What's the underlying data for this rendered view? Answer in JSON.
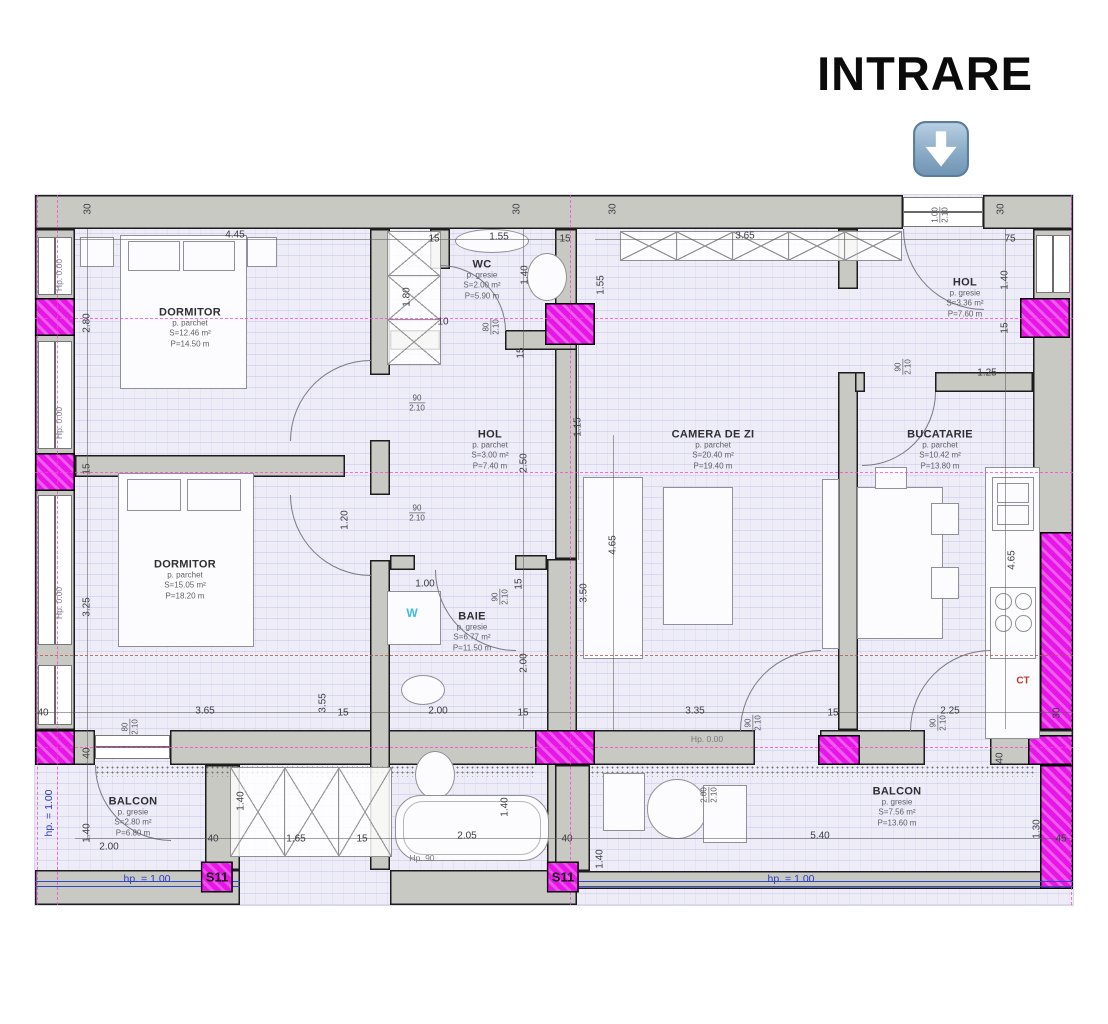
{
  "entrance": {
    "heading": "INTRARE",
    "icon": "down-arrow-icon"
  },
  "rooms": [
    {
      "id": "dormitor-1",
      "name": "DORMITOR",
      "floor": "p. parchet",
      "area": "S=12.46 m²",
      "perimeter": "P=14.50 m",
      "x": 155,
      "y": 133
    },
    {
      "id": "wc",
      "name": "WC",
      "floor": "p. gresie",
      "area": "S=2.00 m²",
      "perimeter": "P=5.90 m",
      "x": 447,
      "y": 85
    },
    {
      "id": "hol-entry",
      "name": "HOL",
      "floor": "p. gresie",
      "area": "S=3.36 m²",
      "perimeter": "P=7.60 m",
      "x": 930,
      "y": 103
    },
    {
      "id": "hol",
      "name": "HOL",
      "floor": "p. parchet",
      "area": "S=3.00 m²",
      "perimeter": "P=7.40 m",
      "x": 455,
      "y": 255
    },
    {
      "id": "camera-de-zi",
      "name": "CAMERA DE ZI",
      "floor": "p. parchet",
      "area": "S=20.40 m²",
      "perimeter": "P=19.40 m",
      "x": 678,
      "y": 255
    },
    {
      "id": "bucatarie",
      "name": "BUCATARIE",
      "floor": "p. parchet",
      "area": "S=10.42 m²",
      "perimeter": "P=13.80 m",
      "x": 905,
      "y": 255
    },
    {
      "id": "dormitor-2",
      "name": "DORMITOR",
      "floor": "p. parchet",
      "area": "S=15.05 m²",
      "perimeter": "P=18.20 m",
      "x": 150,
      "y": 385
    },
    {
      "id": "baie",
      "name": "BAIE",
      "floor": "p. gresie",
      "area": "S=6.77 m²",
      "perimeter": "P=11.50 m",
      "x": 437,
      "y": 437
    },
    {
      "id": "balcon-1",
      "name": "BALCON",
      "floor": "p. gresie",
      "area": "S=2.80 m²",
      "perimeter": "P=6.80 m",
      "x": 98,
      "y": 622
    },
    {
      "id": "balcon-2",
      "name": "BALCON",
      "floor": "p. gresie",
      "area": "S=7.56 m²",
      "perimeter": "P=13.60 m",
      "x": 862,
      "y": 612
    }
  ],
  "dims": [
    {
      "t": "30",
      "x": 53,
      "y": 14,
      "r": 1
    },
    {
      "t": "4.45",
      "x": 200,
      "y": 40
    },
    {
      "t": "15",
      "x": 399,
      "y": 44
    },
    {
      "t": "1.55",
      "x": 464,
      "y": 42
    },
    {
      "t": "15",
      "x": 530,
      "y": 44
    },
    {
      "t": "30",
      "x": 482,
      "y": 14,
      "r": 1
    },
    {
      "t": "30",
      "x": 578,
      "y": 14,
      "r": 1
    },
    {
      "t": "3.65",
      "x": 710,
      "y": 41
    },
    {
      "t": "1.00",
      "t2": "2.10",
      "x": 905,
      "y": 20,
      "r": 1,
      "c": "door"
    },
    {
      "t": "30",
      "x": 966,
      "y": 14,
      "r": 1
    },
    {
      "t": "75",
      "x": 975,
      "y": 44
    },
    {
      "t": "Hp. 0.00",
      "x": 24,
      "y": 80,
      "r": 1,
      "c": "axis"
    },
    {
      "t": "2.80",
      "x": 52,
      "y": 128,
      "r": 1
    },
    {
      "t": "Hp. 0.00",
      "x": 24,
      "y": 228,
      "r": 1,
      "c": "axis"
    },
    {
      "t": "15",
      "x": 52,
      "y": 274,
      "r": 1
    },
    {
      "t": "Hp. 0.00",
      "x": 24,
      "y": 408,
      "r": 1,
      "c": "axis"
    },
    {
      "t": "3.25",
      "x": 52,
      "y": 412,
      "r": 1
    },
    {
      "t": "40",
      "x": 8,
      "y": 518
    },
    {
      "t": "40",
      "x": 52,
      "y": 558,
      "r": 1
    },
    {
      "t": "hp. = 1.00",
      "x": 14,
      "y": 618,
      "r": 1,
      "c": "blue"
    },
    {
      "t": "1.40",
      "x": 52,
      "y": 638,
      "r": 1
    },
    {
      "t": "2.00",
      "x": 74,
      "y": 652
    },
    {
      "t": "1.80",
      "x": 372,
      "y": 102,
      "r": 1
    },
    {
      "t": "10",
      "x": 408,
      "y": 127
    },
    {
      "t": "80",
      "t2": "2.10",
      "x": 456,
      "y": 132,
      "r": 1,
      "c": "door"
    },
    {
      "t": "1.40",
      "x": 490,
      "y": 80,
      "r": 1
    },
    {
      "t": "1.55",
      "x": 566,
      "y": 90,
      "r": 1
    },
    {
      "t": "15",
      "x": 486,
      "y": 158,
      "r": 1
    },
    {
      "t": "1.15",
      "x": 543,
      "y": 232,
      "r": 1
    },
    {
      "t": "90",
      "t2": "2.10",
      "x": 382,
      "y": 208,
      "c": "door"
    },
    {
      "t": "2.50",
      "x": 489,
      "y": 268,
      "r": 1
    },
    {
      "t": "90",
      "t2": "2.10",
      "x": 382,
      "y": 318,
      "c": "door"
    },
    {
      "t": "1.20",
      "x": 310,
      "y": 325,
      "r": 1
    },
    {
      "t": "1.00",
      "x": 390,
      "y": 389
    },
    {
      "t": "15",
      "x": 484,
      "y": 389,
      "r": 1
    },
    {
      "t": "90",
      "t2": "2.10",
      "x": 465,
      "y": 402,
      "r": 1,
      "c": "door"
    },
    {
      "t": "2.00",
      "x": 489,
      "y": 468,
      "r": 1
    },
    {
      "t": "3.50",
      "x": 549,
      "y": 398,
      "r": 1
    },
    {
      "t": "4.65",
      "x": 578,
      "y": 350,
      "r": 1
    },
    {
      "t": "1.40",
      "x": 970,
      "y": 85,
      "r": 1
    },
    {
      "t": "15",
      "x": 970,
      "y": 133,
      "r": 1
    },
    {
      "t": "90",
      "t2": "2.10",
      "x": 868,
      "y": 172,
      "r": 1,
      "c": "door"
    },
    {
      "t": "1.25",
      "x": 952,
      "y": 178
    },
    {
      "t": "4.65",
      "x": 977,
      "y": 365,
      "r": 1
    },
    {
      "t": "CT",
      "x": 988,
      "y": 486,
      "c": "red"
    },
    {
      "t": "3.65",
      "x": 170,
      "y": 516
    },
    {
      "t": "80",
      "t2": "2.10",
      "x": 95,
      "y": 532,
      "r": 1,
      "c": "door"
    },
    {
      "t": "3.55",
      "x": 288,
      "y": 508,
      "r": 1
    },
    {
      "t": "15",
      "x": 308,
      "y": 518
    },
    {
      "t": "2.00",
      "x": 403,
      "y": 516
    },
    {
      "t": "15",
      "x": 488,
      "y": 518
    },
    {
      "t": "3.35",
      "x": 660,
      "y": 516
    },
    {
      "t": "90",
      "t2": "2.10",
      "x": 718,
      "y": 528,
      "r": 1,
      "c": "door"
    },
    {
      "t": "15",
      "x": 798,
      "y": 518
    },
    {
      "t": "90",
      "t2": "2.10",
      "x": 903,
      "y": 528,
      "r": 1,
      "c": "door"
    },
    {
      "t": "2.25",
      "x": 915,
      "y": 516
    },
    {
      "t": "30",
      "x": 1022,
      "y": 518,
      "r": 1
    },
    {
      "t": "Hp. 0.00",
      "x": 672,
      "y": 544,
      "c": "axis"
    },
    {
      "t": "40",
      "x": 965,
      "y": 563,
      "r": 1
    },
    {
      "t": "40",
      "x": 178,
      "y": 644
    },
    {
      "t": "1.40",
      "x": 206,
      "y": 606,
      "r": 1
    },
    {
      "t": "1.65",
      "x": 261,
      "y": 644
    },
    {
      "t": "15",
      "x": 327,
      "y": 644
    },
    {
      "t": "2.05",
      "x": 432,
      "y": 641
    },
    {
      "t": "Hp. 90",
      "x": 387,
      "y": 663,
      "c": "axis"
    },
    {
      "t": "1.40",
      "x": 470,
      "y": 612,
      "r": 1
    },
    {
      "t": "40",
      "x": 532,
      "y": 644
    },
    {
      "t": "1.40",
      "x": 565,
      "y": 664,
      "r": 1
    },
    {
      "t": "2.00",
      "t2": "2.10",
      "x": 674,
      "y": 600,
      "r": 1,
      "c": "door"
    },
    {
      "t": "5.40",
      "x": 785,
      "y": 641
    },
    {
      "t": "1.30",
      "x": 1002,
      "y": 634,
      "r": 1
    },
    {
      "t": "45",
      "x": 1026,
      "y": 644
    },
    {
      "t": "hp. = 1.00",
      "x": 112,
      "y": 684,
      "c": "blue"
    },
    {
      "t": "hp. = 1.00",
      "x": 756,
      "y": 684,
      "c": "blue"
    },
    {
      "t": "S11",
      "x": 182,
      "y": 682,
      "c": "s11"
    },
    {
      "t": "S11",
      "x": 528,
      "y": 682,
      "c": "s11"
    },
    {
      "t": "W",
      "x": 377,
      "y": 418,
      "c": "wm"
    }
  ]
}
